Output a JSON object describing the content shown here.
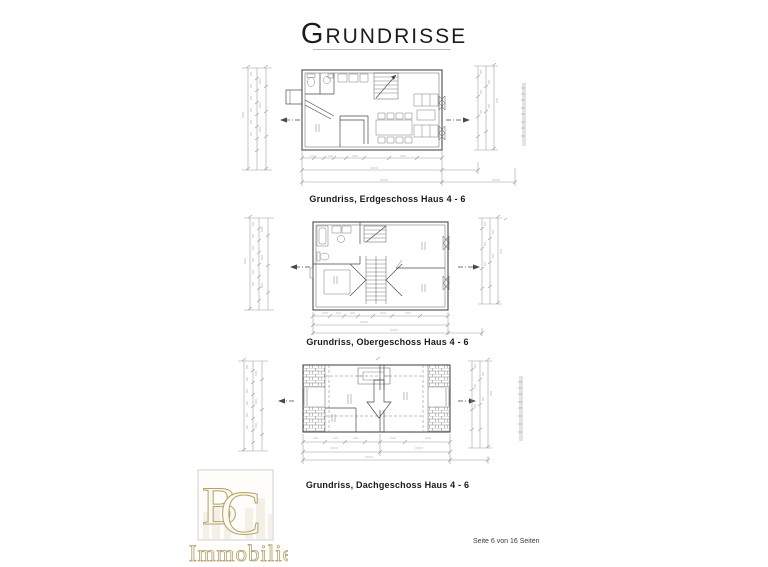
{
  "page": {
    "title": "Grundrisse",
    "footer": "Seite 6 von 16 Seiten"
  },
  "figures": [
    {
      "caption": "Grundriss, Erdgeschoss  Haus 4 - 6"
    },
    {
      "caption": "Grundriss, Obergeschoss Haus 4 - 6"
    },
    {
      "caption": "Grundriss, Dachgeschoss Haus 4 - 6"
    }
  ],
  "logo": {
    "monogram_b": "B",
    "monogram_c": "C",
    "name": "Immobilien"
  },
  "colors": {
    "ink": "#4a4a4a",
    "ink2": "#7a7a7a",
    "dim": "#9a9a9a",
    "gold": "#b3a26a",
    "caption": "#1a1a1a"
  }
}
